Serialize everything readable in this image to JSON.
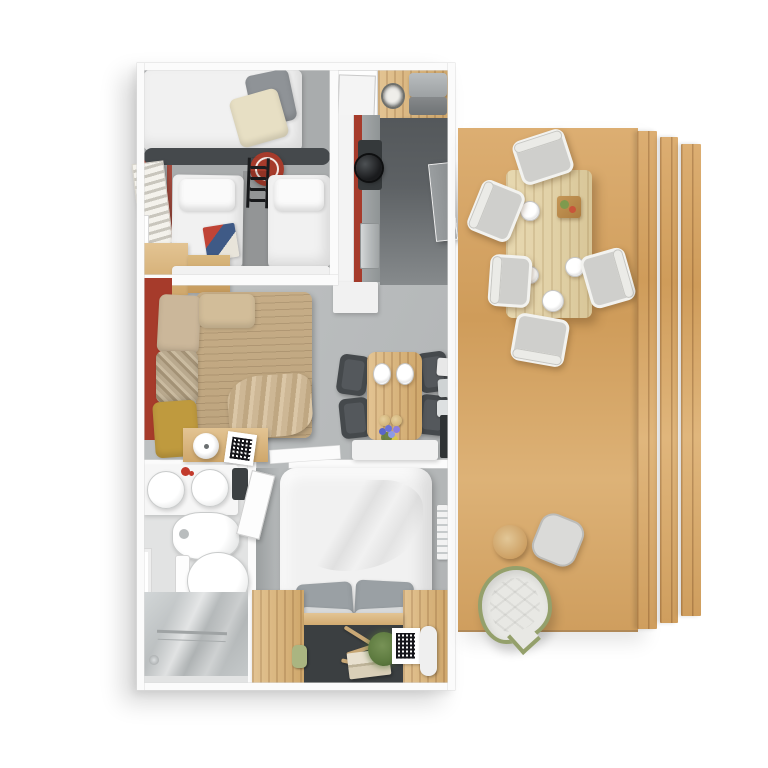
{
  "scene": {
    "type": "3d-floor-plan-top-down-render",
    "subject": "holiday lodge / mobile home floor plan with wooden terrace deck",
    "visible_text": "none"
  },
  "colors": {
    "background": "#ffffff",
    "wall_white": "#fbfbfb",
    "floor_gray": "#b8bbbc",
    "floor_gray_dark": "#a9acad",
    "kitchen_floor_dark": "#5d6164",
    "bathroom_floor": "#e2e3e3",
    "accent_red": "#a63b2b",
    "dark_furniture": "#45494c",
    "wood_mid": "#cfa76b",
    "wood_light": "#e3c493",
    "pale_table_wood": "#e2d2a8",
    "sofa_tan": "#c6ad87",
    "mustard": "#bf9a3e",
    "beige": "#cbb79a",
    "linen_white": "#f1f1f1",
    "pillow_gray": "#9aa0a4",
    "chair_gray": "#cfcfcc",
    "stainless": "#b9bdbe",
    "plant_green": "#5d7a3f",
    "olive_rim": "#94a06b",
    "pot_black": "#1a1b1d"
  },
  "unit": {
    "rooms": [
      {
        "name": "kids-bedroom",
        "furniture": [
          "bunk-bed-top",
          "twin-bed-left",
          "twin-bed-right",
          "bunk-ladder",
          "red-ring-toy",
          "window-blinds",
          "window",
          "wood-dresser",
          "white-ledge",
          "magazine"
        ]
      },
      {
        "name": "kitchen",
        "furniture": [
          "entry-alcove-door",
          "wood-counter-top",
          "utensil-pot",
          "coffee-machine",
          "appliance-unit",
          "kitchen-counter",
          "gas-hob",
          "cooking-pot",
          "sink",
          "deck-door"
        ]
      },
      {
        "name": "living-room",
        "furniture": [
          "corner-sofa",
          "beige-cushion",
          "patterned-cushion",
          "mustard-cushion",
          "blanket",
          "side-table",
          "lamp",
          "qr-book",
          "red-accent-wall"
        ]
      },
      {
        "name": "dining-area",
        "furniture": [
          "dining-table",
          "dining-chair-x4",
          "plate-x2",
          "bread-rolls",
          "flower-bouquet",
          "white-bench",
          "sideboard",
          "towel-shelf",
          "dark-panel"
        ]
      },
      {
        "name": "bathroom",
        "furniture": [
          "double-sink-vanity",
          "soap-dispenser",
          "dark-shelf",
          "bidet",
          "toilet",
          "window",
          "shower"
        ]
      },
      {
        "name": "master-bedroom",
        "furniture": [
          "double-bed-duvet",
          "gray-pillow-x2",
          "white-pillow-x2",
          "wood-platform-left",
          "wood-platform-right",
          "headboard-shelf",
          "green-cup",
          "driftwood",
          "book-stack",
          "potted-plant",
          "qr-frame",
          "white-roll",
          "door-leaf",
          "towel-radiator"
        ]
      }
    ]
  },
  "deck": {
    "material": "horizontal-wood-planks",
    "fence": "vertical-plank-panels-x3",
    "furniture": [
      "outdoor-dining-table",
      "outdoor-chair-x5",
      "plate-x4",
      "serving-tray",
      "wood-stool",
      "gray-pouf",
      "teardrop-lounge-cushion"
    ]
  }
}
